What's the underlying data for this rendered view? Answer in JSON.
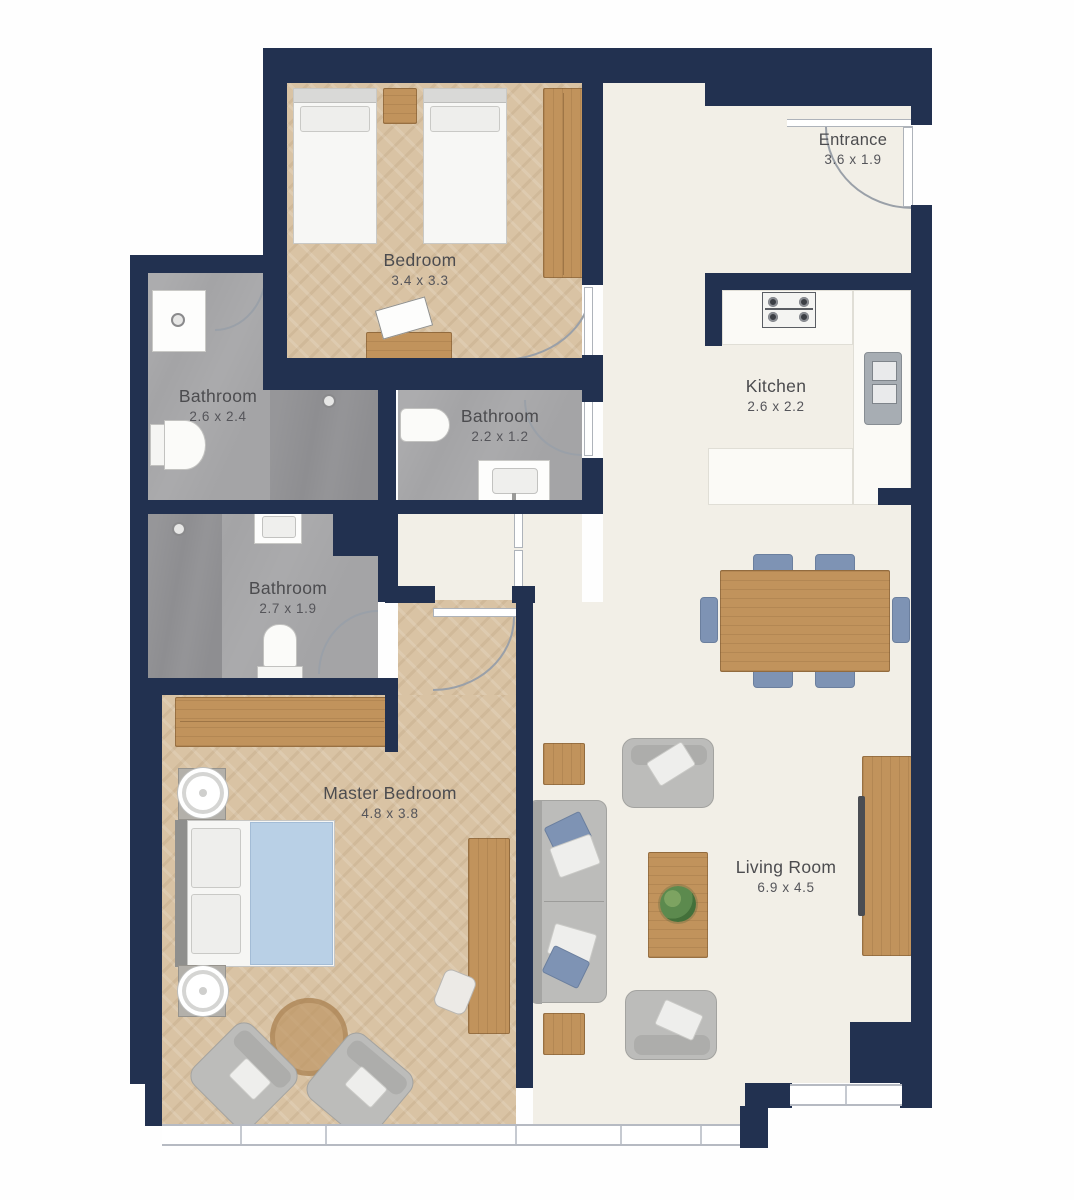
{
  "plan": {
    "title": "Apartment floor plan",
    "colors": {
      "wall": "#223150",
      "floor_light": "#f2efe7",
      "floor_wood": "#d9c3a4",
      "floor_bath": "#a4a4a6",
      "floor_bath_dark": "#8e8e91",
      "wood": "#c1935c",
      "chair_blue": "#7e93b4",
      "sofa_gray": "#bcbcba",
      "bed_blanket_blue": "#b9d0e6",
      "label_text": "#4c4c4f"
    },
    "rooms": [
      {
        "id": "bedroom",
        "name": "Bedroom",
        "dims": "3.4 x 3.3"
      },
      {
        "id": "bathroom-1",
        "name": "Bathroom",
        "dims": "2.6 x 2.4"
      },
      {
        "id": "bathroom-2",
        "name": "Bathroom",
        "dims": "2.2 x 1.2"
      },
      {
        "id": "bathroom-3",
        "name": "Bathroom",
        "dims": "2.7 x 1.9"
      },
      {
        "id": "kitchen",
        "name": "Kitchen",
        "dims": "2.6 x 2.2"
      },
      {
        "id": "master-bedroom",
        "name": "Master Bedroom",
        "dims": "4.8 x 3.8"
      },
      {
        "id": "living-room",
        "name": "Living Room",
        "dims": "6.9 x 4.5"
      },
      {
        "id": "entrance",
        "name": "Entrance",
        "dims": "3.6 x 1.9"
      }
    ]
  }
}
